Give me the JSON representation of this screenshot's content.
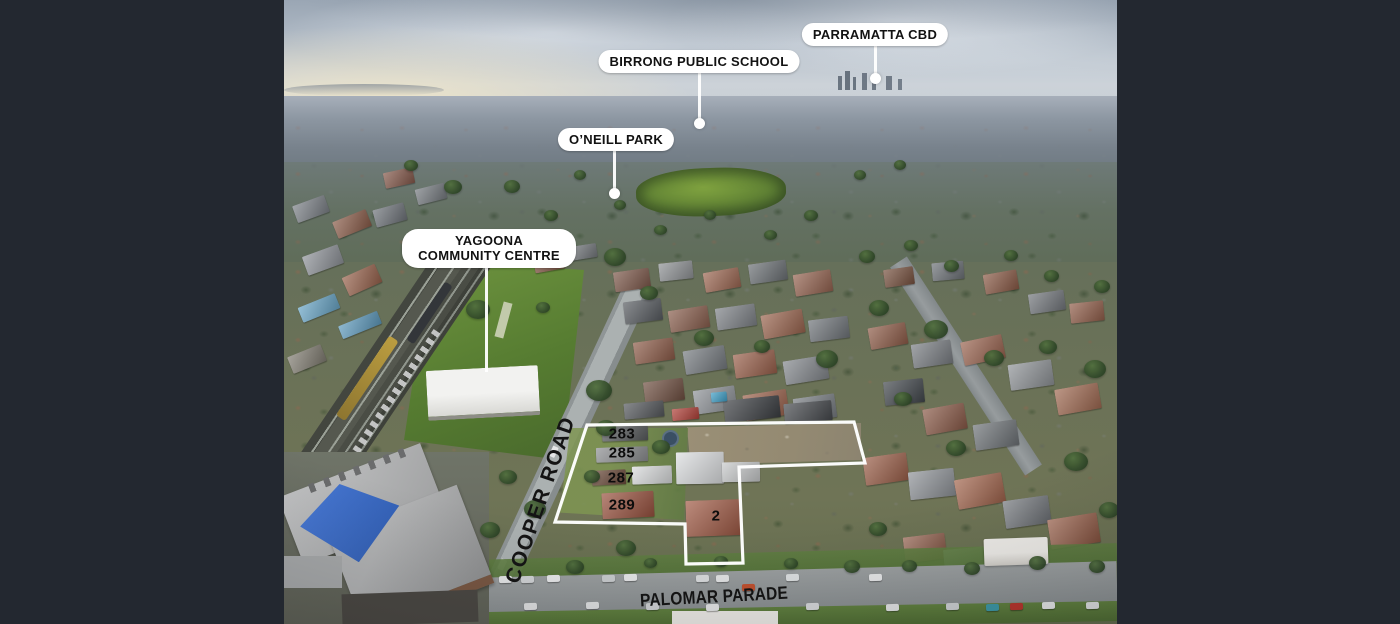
{
  "callouts": [
    {
      "id": "parramatta-cbd",
      "text": "PARRAMATTA CBD"
    },
    {
      "id": "birrong-public-school",
      "text": "BIRRONG PUBLIC SCHOOL"
    },
    {
      "id": "oneill-park",
      "text": "O’NEILL PARK"
    },
    {
      "id": "yagoona-community-centre",
      "text": "YAGOONA COMMUNITY CENTRE"
    }
  ],
  "street_labels": [
    {
      "id": "cooper-road",
      "text": "COOPER ROAD"
    },
    {
      "id": "palomar-parade",
      "text": "PALOMAR PARADE"
    }
  ],
  "lot_numbers": [
    "283",
    "285",
    "287",
    "289",
    "2"
  ],
  "colors": {
    "letterbox": "#232830",
    "callout_bg": "#ffffff",
    "callout_text": "#121212",
    "boundary_line": "#ffffff",
    "street_text": "#141414",
    "lot_text": "#0c0c0c"
  }
}
